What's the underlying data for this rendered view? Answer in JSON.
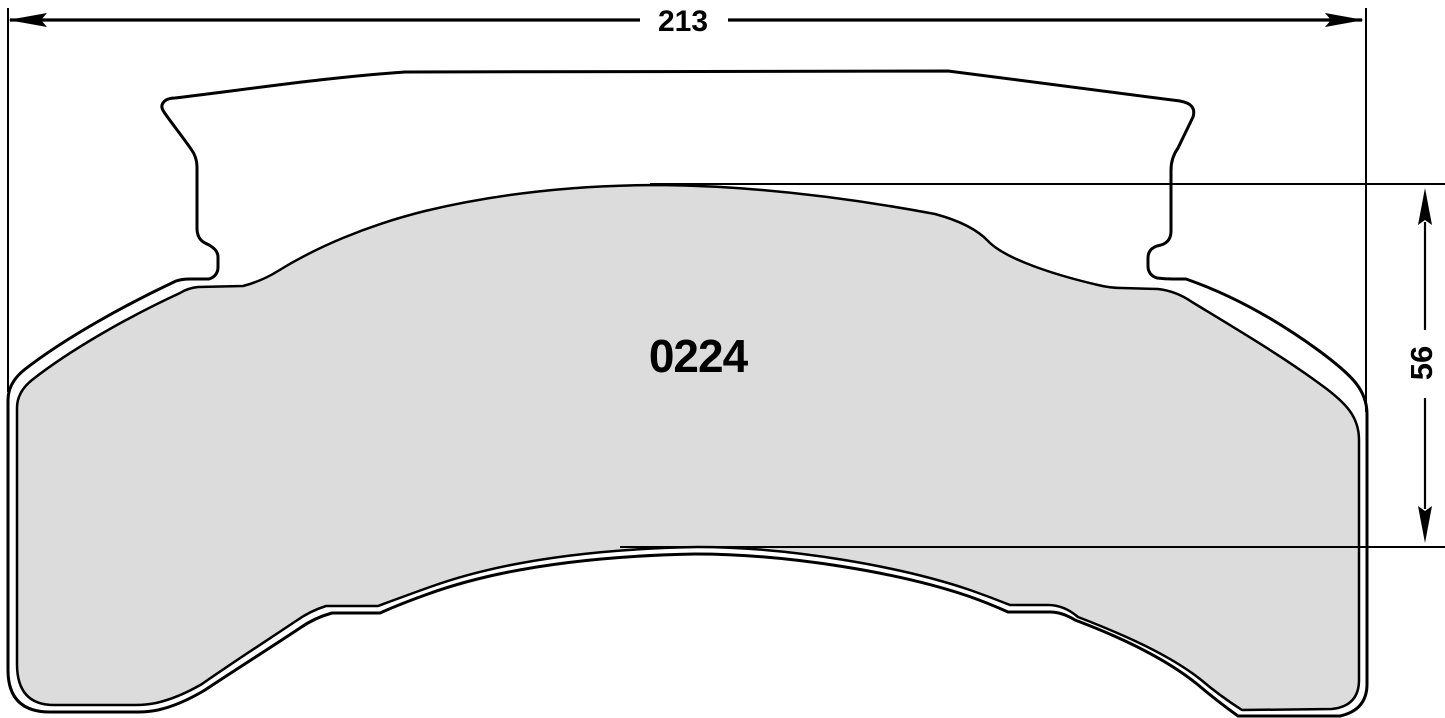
{
  "drawing": {
    "part_number": "0224",
    "width_dimension": "213",
    "height_dimension": "56",
    "colors": {
      "friction": "#dcdcdc",
      "line": "#000000",
      "background": "#ffffff"
    }
  }
}
